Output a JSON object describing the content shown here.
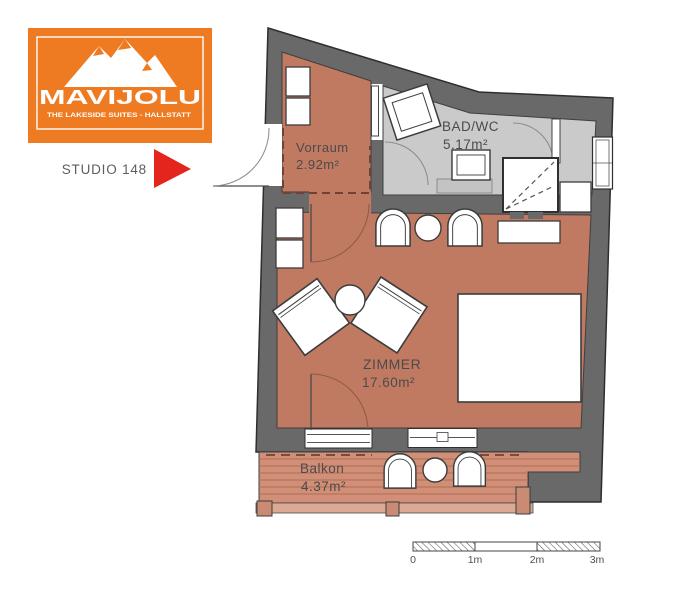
{
  "logo": {
    "title": "MAVIJOLU",
    "tagline": "THE LAKESIDE SUITES - HALLSTATT"
  },
  "unit": {
    "label": "STUDIO 148"
  },
  "rooms": {
    "vorraum": {
      "name": "Vorraum",
      "area": "2.92m²"
    },
    "bad": {
      "name": "BAD/WC",
      "area": "5.17m²"
    },
    "zimmer": {
      "name": "ZIMMER",
      "area": "17.60m²"
    },
    "balkon": {
      "name": "Balkon",
      "area": "4.37m²"
    }
  },
  "scale_bar": {
    "labels": [
      "0",
      "1m",
      "2m",
      "3m"
    ]
  },
  "colors": {
    "brand_orange": "#ee7b22",
    "flag_red": "#e3251d",
    "wall_gray": "#696969",
    "room_floor": "#c17a62",
    "bath_floor": "#cacaca",
    "deck_floor": "#d18f77"
  }
}
